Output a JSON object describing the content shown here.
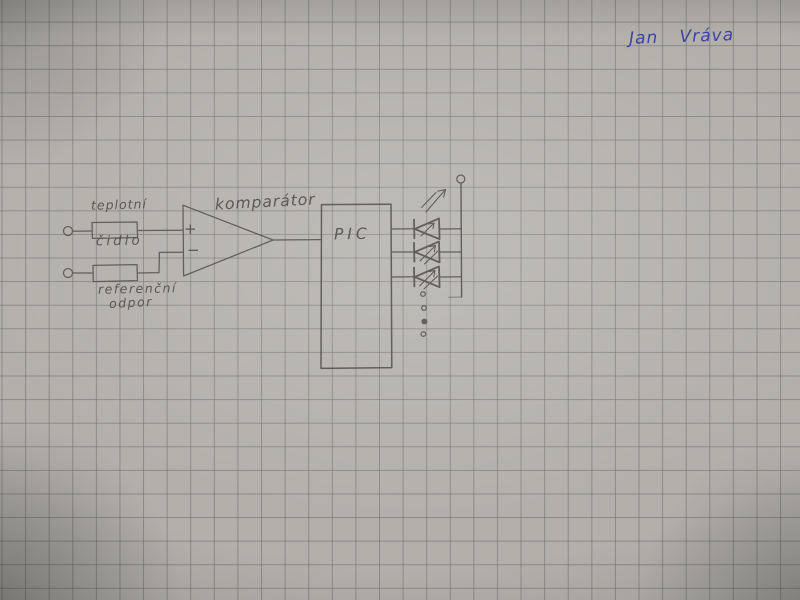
{
  "signature": {
    "text": "Jan Vráva"
  },
  "labels": {
    "sensor_top": "teplotní",
    "sensor_bottom": "čidlo",
    "reference_top": "referenční",
    "reference_bottom": "odpor",
    "comparator": "komparátor",
    "comparator_plus": "+",
    "comparator_minus": "−",
    "pic": "PIC"
  },
  "leds": {
    "drawn_count": 3,
    "continuation_dots": 4
  },
  "colors": {
    "paper": "#b2b0a9",
    "grid_line": "#696b68",
    "pencil": "#4e4c45",
    "ink_blue": "#3d43a4"
  }
}
